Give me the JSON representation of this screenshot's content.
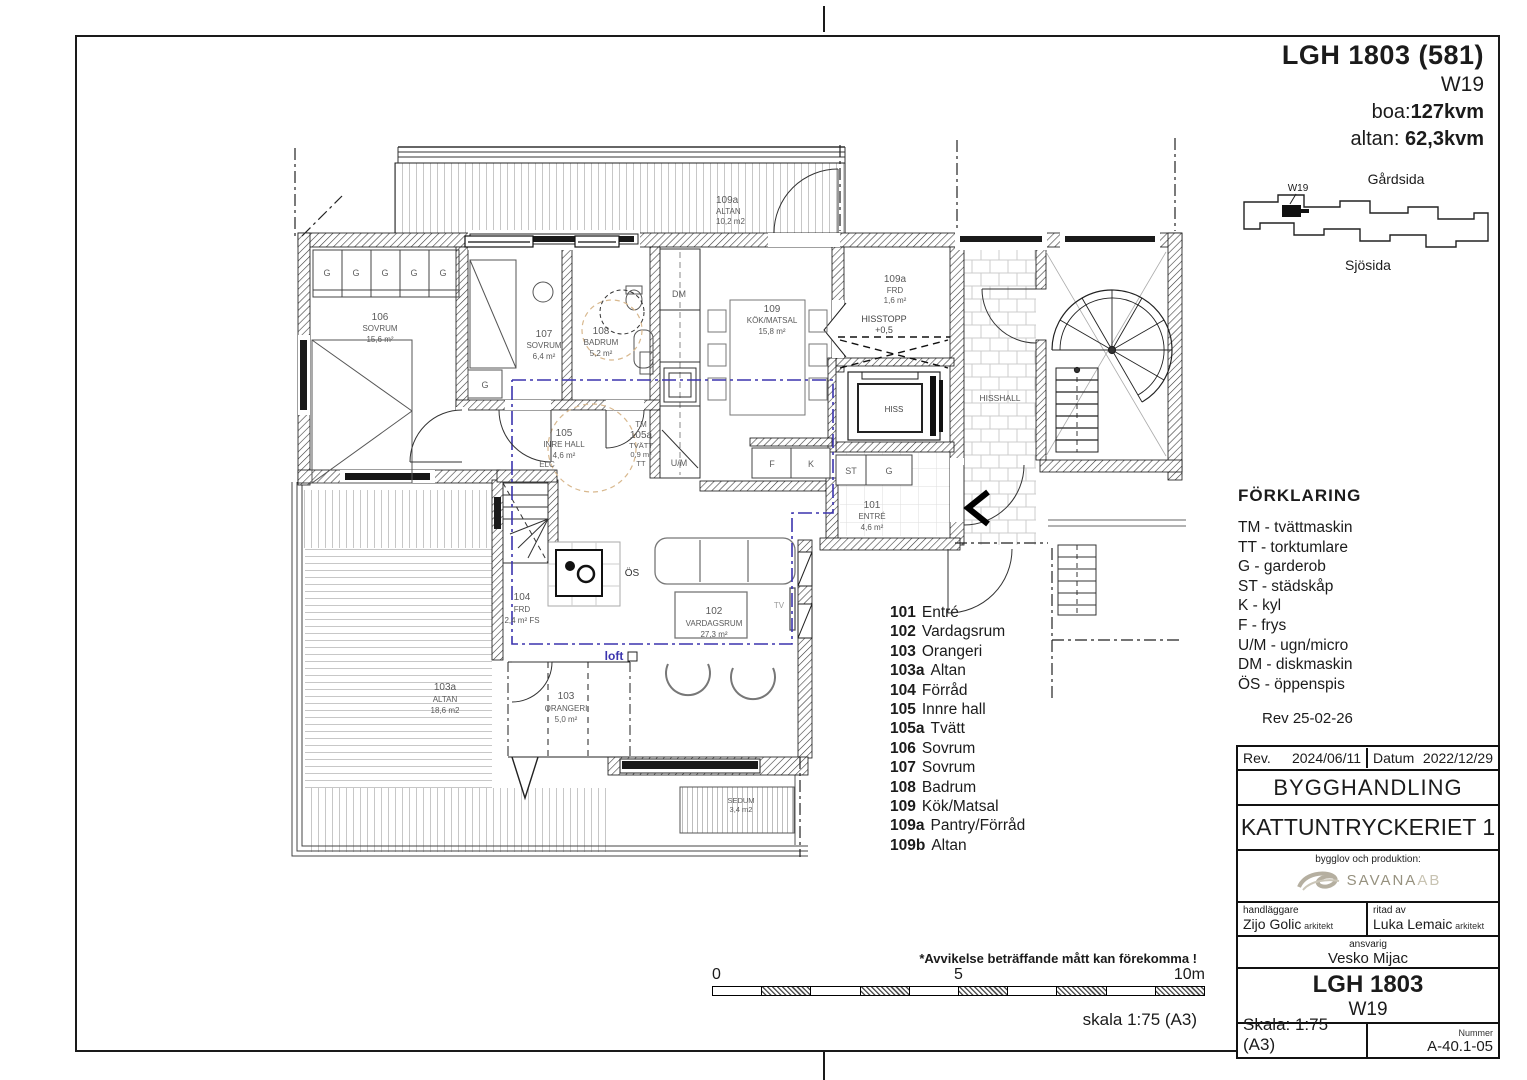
{
  "header": {
    "title": "LGH 1803 (581)",
    "unit": "W19",
    "boa_label": "boa:",
    "boa_value": "127kvm",
    "altan_label": "altan: ",
    "altan_value": "62,3kvm"
  },
  "site": {
    "garden_side": "Gårdsida",
    "sea_side": "Sjösida",
    "unit_marker": "W19"
  },
  "forklaring": {
    "title": "FÖRKLARING",
    "items": [
      "TM - tvättmaskin",
      "TT - torktumlare",
      "G - garderob",
      "ST - städskåp",
      "K - kyl",
      "F - frys",
      "U/M - ugn/micro",
      "DM - diskmaskin",
      "ÖS - öppenspis"
    ],
    "rev": "Rev 25-02-26"
  },
  "room_list": [
    {
      "num": "101",
      "name": "Entré"
    },
    {
      "num": "102",
      "name": "Vardagsrum"
    },
    {
      "num": "103",
      "name": "Orangeri"
    },
    {
      "num": "103a",
      "name": "Altan"
    },
    {
      "num": "104",
      "name": "Förråd"
    },
    {
      "num": "105",
      "name": "Innre hall"
    },
    {
      "num": "105a",
      "name": "Tvätt"
    },
    {
      "num": "106",
      "name": "Sovrum"
    },
    {
      "num": "107",
      "name": "Sovrum"
    },
    {
      "num": "108",
      "name": "Badrum"
    },
    {
      "num": "109",
      "name": "Kök/Matsal"
    },
    {
      "num": "109a",
      "name": "Pantry/Förråd"
    },
    {
      "num": "109b",
      "name": "Altan"
    }
  ],
  "title_block": {
    "rev_label": "Rev.",
    "rev_value": "2024/06/11",
    "datum_label": "Datum",
    "datum_value": "2022/12/29",
    "doc_type": "BYGGHANDLING",
    "project": "KATTUNTRYCKERIET 1",
    "produktion_label": "bygglov och produktion:",
    "company": "SAVANA",
    "company_suffix": "AB",
    "handlaggare_label": "handläggare",
    "handlaggare": "Zijo Golic",
    "handlaggare_title": "arkitekt",
    "ritad_label": "ritad av",
    "ritad": "Luka Lemaic",
    "ritad_title": "arkitekt",
    "ansvarig_label": "ansvarig",
    "ansvarig": "Vesko Mijac",
    "unit": "LGH 1803",
    "unit_sub": "W19",
    "skala": "Skala: 1:75 (A3)",
    "nummer_label": "Nummer",
    "nummer": "A-40.1-05"
  },
  "footnote": "*Avvikelse beträffande mått kan förekomma !",
  "scale_bar": {
    "zero": "0",
    "five": "5",
    "ten": "10m",
    "caption": "skala 1:75 (A3)"
  },
  "plan": {
    "rooms": {
      "r101": {
        "num": "101",
        "name": "ENTRÉ",
        "area": "4,6 m²"
      },
      "r102": {
        "num": "102",
        "name": "VARDAGSRUM",
        "area": "27,3 m²"
      },
      "r103": {
        "num": "103",
        "name": "ORANGERI",
        "area": "5,0 m²"
      },
      "r103a": {
        "num": "103a",
        "name": "ALTAN",
        "area": "18,6 m2"
      },
      "r104": {
        "num": "104",
        "name": "FRD",
        "area": "2,4 m² FS"
      },
      "r105": {
        "num": "105",
        "name": "INRE HALL",
        "area": "4,6 m²"
      },
      "r105a": {
        "num": "105a",
        "name": "TVÄTT",
        "area": "0,9 m²"
      },
      "r106": {
        "num": "106",
        "name": "SOVRUM",
        "area": "15,6 m²"
      },
      "r107": {
        "num": "107",
        "name": "SOVRUM",
        "area": "6,4 m²"
      },
      "r108": {
        "num": "108",
        "name": "BADRUM",
        "area": "5,2 m²"
      },
      "r109": {
        "num": "109",
        "name": "KÖK/MATSAL",
        "area": "15,8 m²"
      },
      "r109a_frd": {
        "num": "109a",
        "name": "FRD",
        "area": "1,6 m²"
      },
      "r109b_altan": {
        "num": "109a",
        "name": "ALTAN",
        "area": "10,2 m2"
      },
      "hisstopp": {
        "name": "HISSTOPP",
        "level": "+0,5"
      },
      "hiss": {
        "name": "HISS"
      },
      "hisshall": {
        "name": "HISSHALL"
      },
      "sedum": {
        "name": "SEDUM",
        "area": "3,4 m2"
      }
    },
    "fixtures": {
      "g": "G",
      "dm": "DM",
      "um": "U/M",
      "f": "F",
      "k": "K",
      "st": "ST",
      "tm": "TM",
      "tt": "TT",
      "elc": "ELC",
      "os": "ÖS",
      "tv": "TV",
      "loft": "loft"
    },
    "colors": {
      "loft_line": "#3b34ae",
      "shower_dash": "#d8b88e"
    }
  }
}
